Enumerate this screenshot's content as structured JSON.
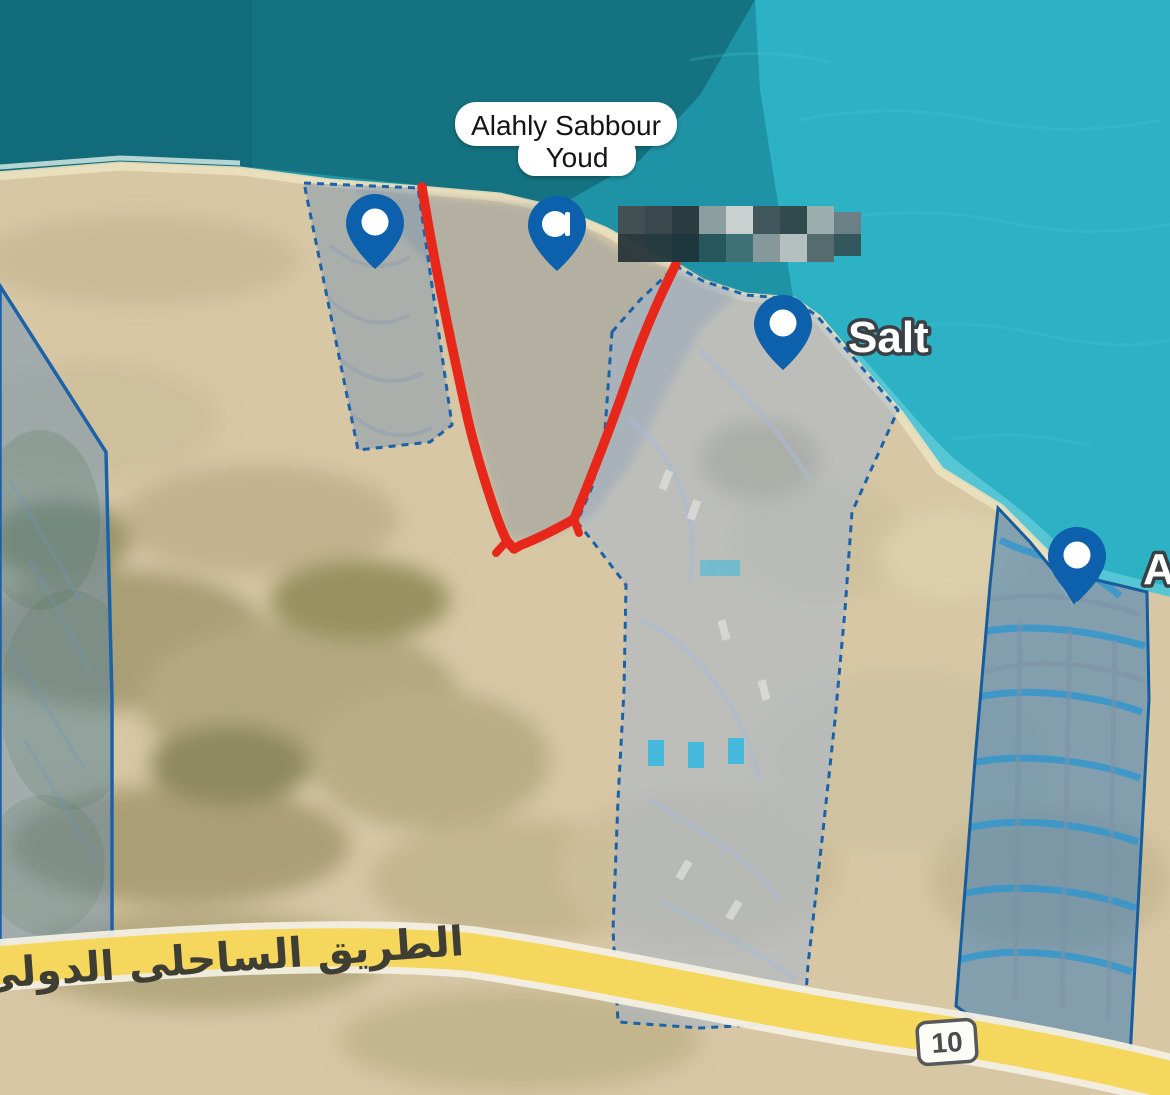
{
  "map": {
    "callout": {
      "line1": "Alahly Sabbour",
      "line2": "Youd"
    },
    "labels": {
      "salt": "Salt",
      "partial_right": "A"
    },
    "road": {
      "name_arabic": "الطريق الساحلى الدولى",
      "route_badge": "10"
    },
    "pins": [
      {
        "id": "pin-northwest-parcel"
      },
      {
        "id": "pin-alahly-sabbour-youd"
      },
      {
        "id": "pin-salt"
      },
      {
        "id": "pin-east-parcel"
      }
    ],
    "colors": {
      "sea_base": "#1e93a6",
      "sea_dark": "#14707e",
      "sea_bright": "#2eb3c6",
      "shallow_water": "#7fd9e4",
      "sand": "#d7c7a5",
      "beach": "#ece1bf",
      "parcel_fill": "#9db4d4",
      "parcel_border": "#1b62a8",
      "route_red": "#e7271a",
      "road_yellow": "#f5d75e",
      "pin_blue": "#0d60ab"
    }
  }
}
